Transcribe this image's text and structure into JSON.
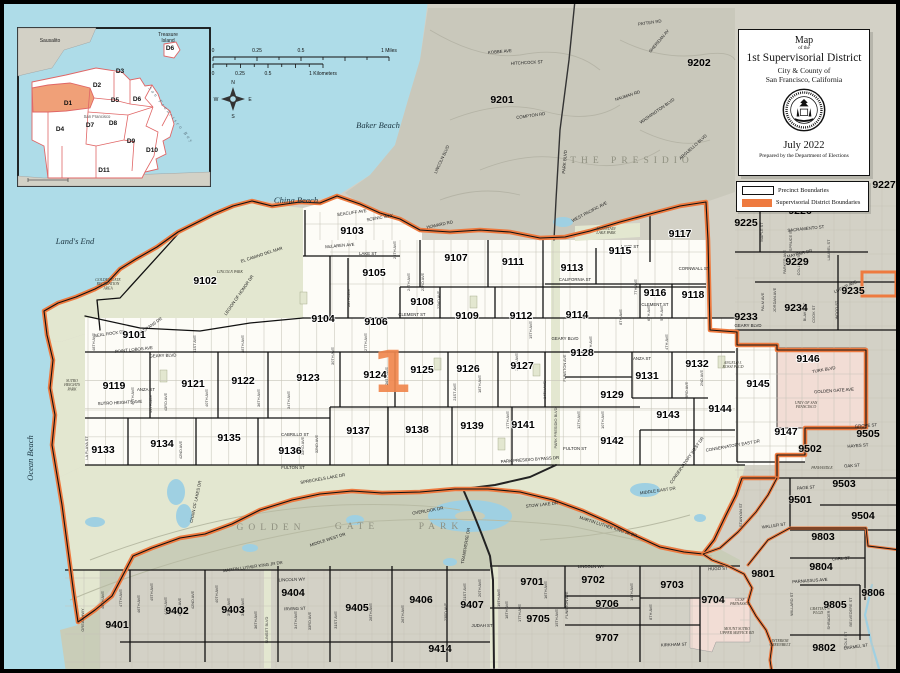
{
  "title_box": {
    "line1": "Map",
    "line2": "of the",
    "line3": "1st Supervisorial District",
    "line4": "City & County of",
    "line5": "San Francisco, California",
    "date": "July 2022",
    "credit": "Prepared by the Department of Elections"
  },
  "legend": {
    "items": [
      {
        "label": "Precinct Boundaries",
        "swatch": "precinct"
      },
      {
        "label": "Supervisorial District Boundaries",
        "swatch": "district"
      }
    ]
  },
  "scale_bar": {
    "miles_labels": [
      "0",
      "0.25",
      "0.5",
      "1 Miles"
    ],
    "km_labels": [
      "0",
      "0.25",
      "0.5",
      "1 Kilometers"
    ]
  },
  "compass": {
    "points": [
      "N",
      "E",
      "S",
      "W"
    ]
  },
  "colors": {
    "water": "#aedce8",
    "land": "#d3d1c6",
    "presidio": "#c9c8bb",
    "park_in": "#e3e7d0",
    "park_out": "#c9cdb8",
    "district_fill": "#fdfcf7",
    "institution_pink": "#f2ddd5",
    "district_boundary": "#ee7a3f",
    "precinct_boundary": "#111111",
    "lake": "#9fd0e2",
    "street": "#c6c4b8"
  },
  "inset": {
    "labels": {
      "sausalito": "Sausalito",
      "treasure_island_1": "Treasure",
      "treasure_island_2": "Island",
      "san_francisco": "San Francisco",
      "bay": "San Francisco Bay"
    },
    "districts": [
      [
        "D1",
        50,
        77
      ],
      [
        "D2",
        79,
        59
      ],
      [
        "D3",
        102,
        45
      ],
      [
        "D4",
        42,
        103
      ],
      [
        "D5",
        97,
        74
      ],
      [
        "D6",
        119,
        73
      ],
      [
        "D6",
        152,
        22
      ],
      [
        "D7",
        72,
        99
      ],
      [
        "D8",
        95,
        97
      ],
      [
        "D9",
        113,
        115
      ],
      [
        "D10",
        134,
        124
      ],
      [
        "D11",
        86,
        144
      ]
    ]
  },
  "map": {
    "district_numeral": "1",
    "precincts_in": [
      [
        "9101",
        134,
        338
      ],
      [
        "9102",
        205,
        284
      ],
      [
        "9103",
        352,
        234
      ],
      [
        "9104",
        323,
        322
      ],
      [
        "9105",
        374,
        276
      ],
      [
        "9106",
        376,
        325
      ],
      [
        "9107",
        456,
        261
      ],
      [
        "9108",
        422,
        305
      ],
      [
        "9109",
        467,
        319
      ],
      [
        "9111",
        513,
        265
      ],
      [
        "9112",
        521,
        319
      ],
      [
        "9113",
        572,
        271
      ],
      [
        "9114",
        577,
        318
      ],
      [
        "9115",
        620,
        254
      ],
      [
        "9116",
        655,
        296
      ],
      [
        "9117",
        680,
        237
      ],
      [
        "9118",
        693,
        298
      ],
      [
        "9119",
        114,
        389
      ],
      [
        "9121",
        193,
        387
      ],
      [
        "9122",
        243,
        384
      ],
      [
        "9123",
        308,
        381
      ],
      [
        "9124",
        375,
        378
      ],
      [
        "9125",
        422,
        373
      ],
      [
        "9126",
        468,
        372
      ],
      [
        "9127",
        522,
        369
      ],
      [
        "9128",
        582,
        356
      ],
      [
        "9129",
        612,
        398
      ],
      [
        "9131",
        647,
        379
      ],
      [
        "9132",
        697,
        367
      ],
      [
        "9133",
        103,
        453
      ],
      [
        "9134",
        162,
        447
      ],
      [
        "9135",
        229,
        441
      ],
      [
        "9136",
        290,
        454
      ],
      [
        "9137",
        358,
        434
      ],
      [
        "9138",
        417,
        433
      ],
      [
        "9139",
        472,
        429
      ],
      [
        "9141",
        523,
        428
      ],
      [
        "9142",
        612,
        444
      ],
      [
        "9143",
        668,
        418
      ],
      [
        "9144",
        720,
        412
      ],
      [
        "9145",
        758,
        387
      ],
      [
        "9146",
        808,
        362
      ],
      [
        "9147",
        786,
        435
      ]
    ],
    "precincts_out": [
      [
        "9201",
        502,
        103
      ],
      [
        "9202",
        699,
        66
      ],
      [
        "9225",
        746,
        226
      ],
      [
        "9226",
        800,
        214
      ],
      [
        "9227",
        884,
        188
      ],
      [
        "9229",
        797,
        265
      ],
      [
        "9233",
        746,
        320
      ],
      [
        "9234",
        796,
        311
      ],
      [
        "9235",
        853,
        294
      ],
      [
        "9401",
        117,
        628
      ],
      [
        "9402",
        177,
        614
      ],
      [
        "9403",
        233,
        613
      ],
      [
        "9404",
        293,
        596
      ],
      [
        "9405",
        357,
        611
      ],
      [
        "9406",
        421,
        603
      ],
      [
        "9407",
        472,
        608
      ],
      [
        "9414",
        440,
        652
      ],
      [
        "9501",
        800,
        503
      ],
      [
        "9502",
        810,
        452
      ],
      [
        "9503",
        844,
        487
      ],
      [
        "9504",
        863,
        519
      ],
      [
        "9505",
        868,
        437
      ],
      [
        "9701",
        532,
        585
      ],
      [
        "9702",
        593,
        583
      ],
      [
        "9703",
        672,
        588
      ],
      [
        "9704",
        713,
        603
      ],
      [
        "9705",
        538,
        622
      ],
      [
        "9706",
        607,
        607
      ],
      [
        "9707",
        607,
        641
      ],
      [
        "9801",
        763,
        577
      ],
      [
        "9802",
        824,
        651
      ],
      [
        "9803",
        823,
        540
      ],
      [
        "9804",
        821,
        570
      ],
      [
        "9805",
        835,
        608
      ],
      [
        "9806",
        873,
        596
      ]
    ],
    "streets": [
      [
        "LAKE ST",
        368,
        255,
        0
      ],
      [
        "LAKE ST",
        630,
        248,
        0
      ],
      [
        "CALIFORNIA ST",
        575,
        281,
        0
      ],
      [
        "CORNWALL ST",
        694,
        270,
        0
      ],
      [
        "CLEMENT ST",
        412,
        316,
        0
      ],
      [
        "CLEMENT ST",
        655,
        306,
        0
      ],
      [
        "GEARY BLVD",
        163,
        357,
        -2
      ],
      [
        "GEARY BLVD",
        565,
        340,
        0
      ],
      [
        "GEARY BLVD",
        748,
        327,
        0
      ],
      [
        "POINT LOBOS AVE",
        134,
        351,
        -6
      ],
      [
        "ANZA ST",
        146,
        391,
        0
      ],
      [
        "ANZA ST",
        642,
        360,
        0
      ],
      [
        "CABRILLO ST",
        295,
        436,
        0
      ],
      [
        "FULTON ST",
        293,
        469,
        0
      ],
      [
        "FULTON ST",
        575,
        450,
        0
      ],
      [
        "PARK PRESIDIO BYPASS DR",
        530,
        461,
        -4
      ],
      [
        "LINCOLN WY",
        292,
        581,
        -2
      ],
      [
        "LINCOLN WY",
        591,
        568,
        0
      ],
      [
        "IRVING ST",
        295,
        610,
        -2
      ],
      [
        "JUDAH ST",
        482,
        627,
        0
      ],
      [
        "MARTIN LUTHER KING JR DR",
        253,
        568,
        -8
      ],
      [
        "MARTIN LUTHER KING JR DR",
        608,
        528,
        18
      ],
      [
        "MIDDLE WEST DR",
        328,
        541,
        -18
      ],
      [
        "MIDDLE EAST DR",
        658,
        492,
        -8
      ],
      [
        "OVERLOOK DR",
        428,
        512,
        -10
      ],
      [
        "STOW LAKE DR",
        542,
        506,
        -6
      ],
      [
        "SPRECKELS LAKE DR",
        323,
        480,
        -10
      ],
      [
        "CHAIN OF LAKES DR",
        197,
        502,
        -78
      ],
      [
        "TRANSVERSE DR",
        467,
        546,
        -80
      ],
      [
        "CONSERVATORY EAST DR",
        733,
        447,
        -10
      ],
      [
        "CONSERVATORY WEST DR",
        688,
        461,
        -55
      ],
      [
        "EL CAMINO DEL MAR",
        262,
        256,
        -18
      ],
      [
        "LEGION OF HONOR DR",
        240,
        296,
        -55
      ],
      [
        "SEAL ROCK DR",
        110,
        335,
        -8
      ],
      [
        "VETERANS DR",
        150,
        328,
        -35
      ],
      [
        "SUTRO HEIGHTS AVE",
        120,
        404,
        -3
      ],
      [
        "McLAREN AVE",
        340,
        247,
        -5
      ],
      [
        "SEACLIFF AVE",
        352,
        214,
        -8
      ],
      [
        "SCENIC WAY",
        380,
        219,
        -10
      ],
      [
        "HOWARD RD",
        440,
        226,
        -12
      ],
      [
        "COMPTON RD",
        531,
        117,
        -8
      ],
      [
        "LINCOLN BLVD",
        443,
        160,
        -65
      ],
      [
        "PARK BLVD",
        566,
        162,
        -85
      ],
      [
        "WASHINGTON BLVD",
        658,
        112,
        -35
      ],
      [
        "ARGUELLO BLVD",
        694,
        148,
        -42
      ],
      [
        "NAUMAN RD",
        628,
        97,
        -18
      ],
      [
        "KOBBE AVE",
        500,
        53,
        -5
      ],
      [
        "HITCHCOCK ST",
        527,
        64,
        -3
      ],
      [
        "PATTEN RD",
        650,
        24,
        -8
      ],
      [
        "SHERIDAN AV",
        660,
        42,
        -50
      ],
      [
        "WEST PACIFIC AVE",
        590,
        213,
        -28
      ],
      [
        "SACRAMENTO ST",
        806,
        230,
        -6
      ],
      [
        "MAYFAIR DR",
        800,
        255,
        -14
      ],
      [
        "LUPINE AVE",
        846,
        288,
        -25
      ],
      [
        "TURK BLVD",
        824,
        371,
        -10
      ],
      [
        "GOLDEN GATE AVE",
        834,
        392,
        -4
      ],
      [
        "GROVE ST",
        866,
        427,
        -4
      ],
      [
        "HAYES ST",
        858,
        447,
        -4
      ],
      [
        "PAGE ST",
        806,
        489,
        -4
      ],
      [
        "OAK ST",
        852,
        467,
        -4
      ],
      [
        "CARL ST",
        841,
        560,
        -3
      ],
      [
        "PARNASSUS AVE",
        810,
        582,
        -4
      ],
      [
        "CARMEL ST",
        856,
        648,
        -8
      ],
      [
        "HUGO ST",
        718,
        570,
        -2
      ],
      [
        "KIRKHAM ST",
        674,
        646,
        -2
      ],
      [
        "WALLER ST",
        774,
        527,
        -8
      ]
    ],
    "avenues": [
      [
        "48TH AVE",
        95,
        342
      ],
      [
        "45TH AVE",
        134,
        396
      ],
      [
        "44TH AVE",
        152,
        404
      ],
      [
        "43RD AVE",
        167,
        402
      ],
      [
        "42ND AVE",
        182,
        450
      ],
      [
        "41ST AVE",
        196,
        344
      ],
      [
        "40TH AVE",
        208,
        398
      ],
      [
        "38TH AVE",
        244,
        344
      ],
      [
        "36TH AVE",
        260,
        398
      ],
      [
        "34TH AVE",
        290,
        400
      ],
      [
        "33RD AVE",
        304,
        446
      ],
      [
        "32ND AVE",
        318,
        444
      ],
      [
        "30TH AVE",
        334,
        356
      ],
      [
        "28TH AVE",
        350,
        298
      ],
      [
        "27TH AVE",
        367,
        342
      ],
      [
        "26TH AVE",
        388,
        376
      ],
      [
        "25TH AVE",
        396,
        250
      ],
      [
        "24TH AVE",
        410,
        282
      ],
      [
        "23RD AVE",
        424,
        282
      ],
      [
        "22ND AVE",
        440,
        300
      ],
      [
        "21ST AVE",
        456,
        392
      ],
      [
        "18TH AVE",
        481,
        384
      ],
      [
        "17TH AVE",
        509,
        420
      ],
      [
        "16TH AVE",
        518,
        362
      ],
      [
        "15TH AVE",
        532,
        330
      ],
      [
        "14TH AVE",
        546,
        390
      ],
      [
        "FUNSTON AVE",
        566,
        368
      ],
      [
        "PARK PRESIDIO BLVD",
        557,
        428
      ],
      [
        "12TH AVE",
        580,
        420
      ],
      [
        "11TH AVE",
        592,
        345
      ],
      [
        "10TH AVE",
        604,
        420
      ],
      [
        "8TH AVE",
        622,
        317
      ],
      [
        "7TH AVE",
        637,
        287
      ],
      [
        "6TH AVE",
        650,
        313
      ],
      [
        "5TH AVE",
        663,
        313
      ],
      [
        "4TH AVE",
        668,
        342
      ],
      [
        "3RD AVE",
        688,
        390
      ],
      [
        "2ND AVE",
        703,
        378
      ],
      [
        "LA PLAYA ST",
        88,
        448
      ],
      [
        "GREAT HWY",
        84,
        620
      ],
      [
        "48TH AVE",
        104,
        600
      ],
      [
        "47TH AVE",
        122,
        598
      ],
      [
        "46TH AVE",
        140,
        604
      ],
      [
        "45TH AVE",
        153,
        592
      ],
      [
        "44TH AVE",
        167,
        606
      ],
      [
        "43RD AVE",
        181,
        607
      ],
      [
        "42ND AVE",
        194,
        600
      ],
      [
        "40TH AVE",
        218,
        594
      ],
      [
        "39TH AVE",
        230,
        607
      ],
      [
        "38TH AVE",
        244,
        607
      ],
      [
        "36TH AVE",
        257,
        620
      ],
      [
        "SUNSET BLVD",
        268,
        630
      ],
      [
        "34TH AVE",
        297,
        620
      ],
      [
        "33RD AVE",
        311,
        621
      ],
      [
        "31ST AVE",
        337,
        620
      ],
      [
        "28TH AVE",
        372,
        612
      ],
      [
        "26TH AVE",
        404,
        614
      ],
      [
        "23RD AVE",
        447,
        612
      ],
      [
        "21ST AVE",
        466,
        592
      ],
      [
        "20TH AVE",
        481,
        588
      ],
      [
        "19TH AVE",
        500,
        598
      ],
      [
        "18TH AVE",
        508,
        610
      ],
      [
        "17TH AVE",
        521,
        613
      ],
      [
        "16TH AVE",
        547,
        590
      ],
      [
        "15TH AVE",
        558,
        618
      ],
      [
        "FUNSTON AVE",
        568,
        605
      ],
      [
        "14TH AVE",
        633,
        592
      ],
      [
        "8TH AVE",
        652,
        612
      ],
      [
        "MAPLE ST",
        763,
        232
      ],
      [
        "LAUREL ST",
        830,
        250
      ],
      [
        "SPRUCE ST",
        792,
        240
      ],
      [
        "PARKER AVE",
        786,
        262
      ],
      [
        "COLLINS ST",
        800,
        264
      ],
      [
        "JORDAN AVE",
        776,
        300
      ],
      [
        "PALM AVE",
        764,
        302
      ],
      [
        "BLAKE ST",
        806,
        312
      ],
      [
        "COOK ST",
        815,
        314
      ],
      [
        "WOOD ST",
        838,
        310
      ],
      [
        "STANYAN ST",
        742,
        515
      ],
      [
        "WILLARD ST",
        793,
        604
      ],
      [
        "SHRADER ST",
        830,
        617
      ],
      [
        "BELVEDERE ST",
        852,
        612
      ],
      [
        "COLE ST",
        847,
        640
      ]
    ],
    "places": [
      {
        "lines": [
          "GOLDEN GATE",
          "RECREATION",
          "AREA"
        ],
        "x": 108,
        "y": 281
      },
      {
        "lines": [
          "SUTRO",
          "HEIGHTS",
          "PARK"
        ],
        "x": 72,
        "y": 382
      },
      {
        "lines": [
          "LINCOLN PARK"
        ],
        "x": 230,
        "y": 273
      },
      {
        "lines": [
          "MOUNTAIN",
          "LAKE PARK"
        ],
        "x": 606,
        "y": 230
      },
      {
        "lines": [
          "UNIV OF SAN",
          "FRANCISCO"
        ],
        "x": 806,
        "y": 404
      },
      {
        "lines": [
          "ANGELO J.",
          "ROSSI PLGD"
        ],
        "x": 733,
        "y": 364
      },
      {
        "lines": [
          "UCSF",
          "PARNASSUS"
        ],
        "x": 740,
        "y": 601
      },
      {
        "lines": [
          "MOUNT SUTRO",
          "UPPER SERVICE RD"
        ],
        "x": 737,
        "y": 630
      },
      {
        "lines": [
          "INTERIOR",
          "GREENBELT"
        ],
        "x": 780,
        "y": 642
      },
      {
        "lines": [
          "PANHANDLE"
        ],
        "x": 822,
        "y": 469
      },
      {
        "lines": [
          "GRATTAN",
          "PLGD"
        ],
        "x": 818,
        "y": 610
      }
    ],
    "water_labels": [
      {
        "text": "Baker Beach",
        "x": 378,
        "y": 128,
        "rot": 0
      },
      {
        "text": "China Beach",
        "x": 296,
        "y": 203,
        "rot": 0
      },
      {
        "text": "Land's End",
        "x": 75,
        "y": 244,
        "rot": 0
      },
      {
        "text": "Ocean Beach",
        "x": 33,
        "y": 458,
        "rot": -90
      }
    ],
    "big_labels": [
      {
        "text": "THE   PRESIDIO",
        "x": 632,
        "y": 163
      },
      {
        "text": "GOLDEN",
        "x": 271,
        "y": 530
      },
      {
        "text": "GATE",
        "x": 357,
        "y": 529
      },
      {
        "text": "PARK",
        "x": 441,
        "y": 529
      }
    ]
  }
}
